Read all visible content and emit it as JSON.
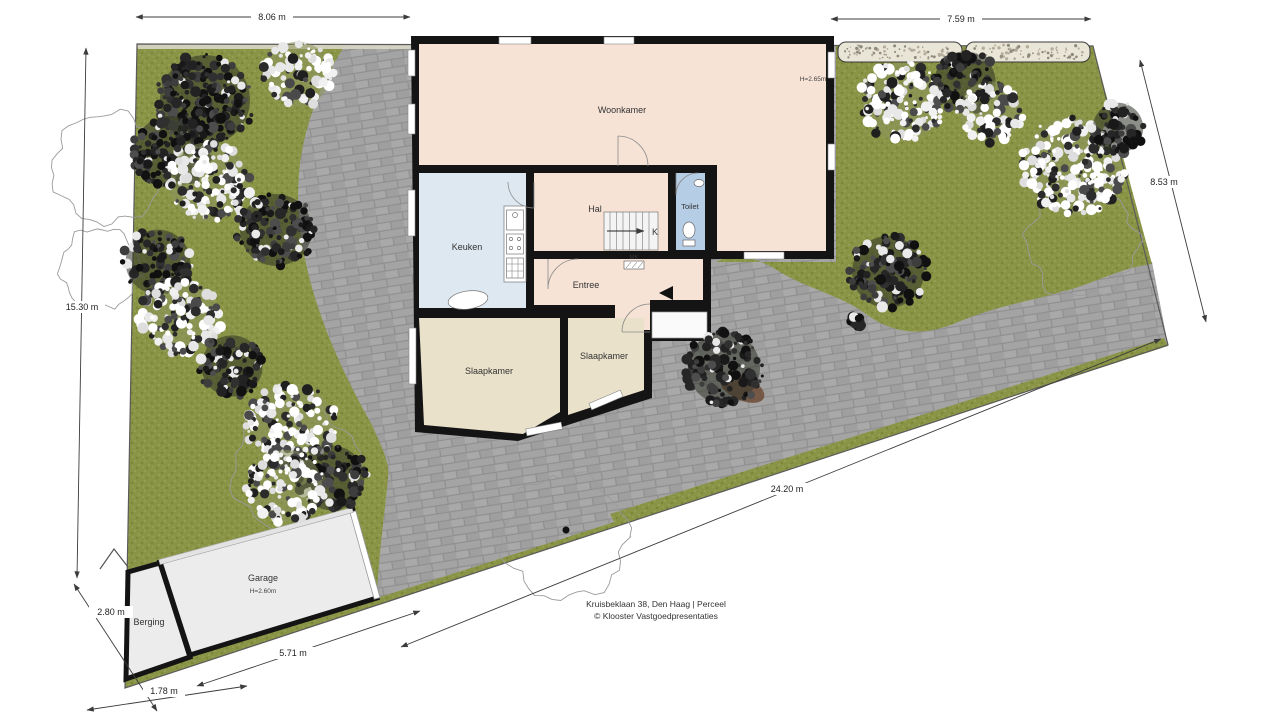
{
  "meta": {
    "address_line": "Kruisbeklaan 38, Den Haag | Perceel",
    "credit_line": "© Klooster Vastgoedpresentaties"
  },
  "rooms": {
    "woonkamer": {
      "label": "Woonkamer",
      "height": "H=2.65m"
    },
    "keuken": {
      "label": "Keuken"
    },
    "hal": {
      "label": "Hal"
    },
    "toilet": {
      "label": "Toilet"
    },
    "entree": {
      "label": "Entree"
    },
    "slaapkamer_links": {
      "label": "Slaapkamer"
    },
    "slaapkamer_rechts": {
      "label": "Slaapkamer"
    },
    "garage": {
      "label": "Garage",
      "height": "H=2.60m"
    },
    "berging": {
      "label": "Berging"
    }
  },
  "annotations": {
    "stairs_direction": "K",
    "meter_cupboard": "MK"
  },
  "dimensions": {
    "top_left": "8.06 m",
    "top_right": "7.59 m",
    "right_side": "8.53 m",
    "left_side": "15.30 m",
    "driveway": "24.20 m",
    "garage_front": "5.71 m",
    "plot_bottom": "1.78 m",
    "plot_bottom_left": "2.80 m"
  },
  "colors": {
    "grass": "#8a9446",
    "grass_dark": "#75812f",
    "grass_light": "#9aa65a",
    "paving": "#a4a4a4",
    "paving_joint": "#8f8f8f",
    "wall": "#141414",
    "room_living": "#f6e3d6",
    "room_bedroom": "#eae1cb",
    "room_kitchen": "#dde8f1",
    "room_toilet": "#b6cde6",
    "garage_fill": "#ececec",
    "hedge_fill": "#eae6d7",
    "dim_line": "#3c3c3c"
  }
}
